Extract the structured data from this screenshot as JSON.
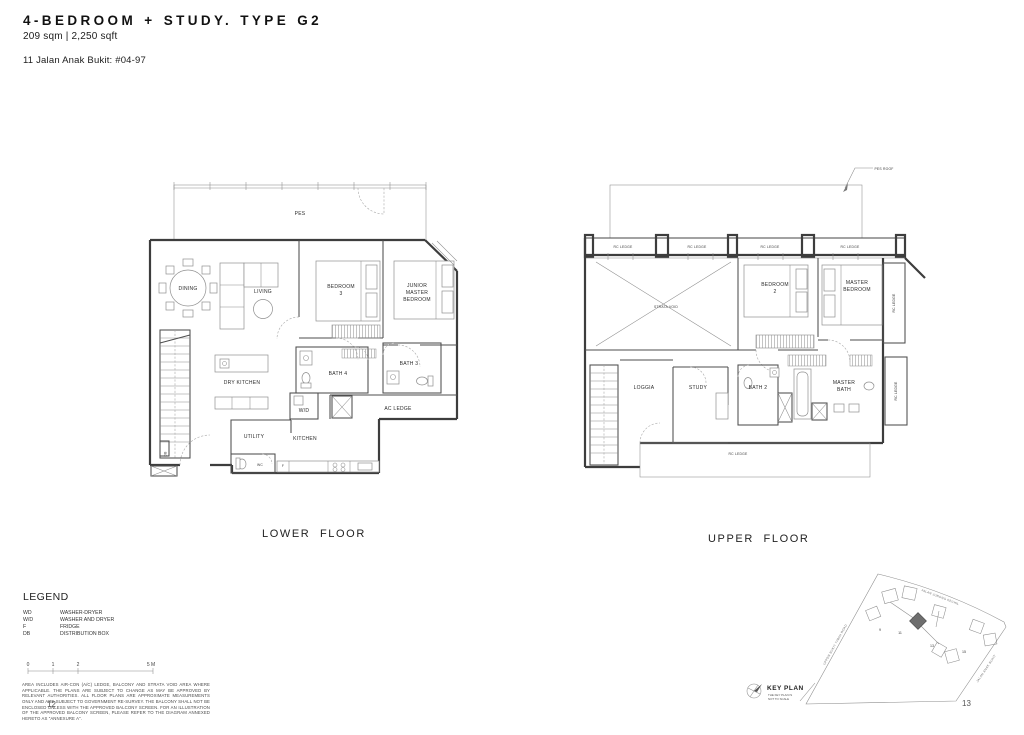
{
  "header": {
    "title": "4-BEDROOM + STUDY. TYPE G2",
    "area": "209 sqm | 2,250 sqft",
    "unit_no": "11 Jalan Anak Bukit: #04-97"
  },
  "floors": {
    "lower_caption": "LOWER FLOOR",
    "upper_caption": "UPPER FLOOR"
  },
  "lower": {
    "pes": "PES",
    "dining": "DINING",
    "living": "LIVING",
    "bedroom3_line1": "BEDROOM",
    "bedroom3_line2": "3",
    "junior_line1": "JUNIOR",
    "junior_line2": "MASTER",
    "junior_line3": "BEDROOM",
    "dry_kitchen": "DRY KITCHEN",
    "utility": "UTILITY",
    "kitchen": "KITCHEN",
    "wc": "WC",
    "bath3": "BATH 3",
    "bath4": "BATH 4",
    "ac_ledge": "AC LEDGE",
    "wd": "W/D",
    "fridge": "F",
    "db": "DB"
  },
  "upper": {
    "pes_roof": "PES ROOF",
    "rc_ledge": "RC LEDGE",
    "strata_void": "STRATA VOID",
    "bedroom2_line1": "BEDROOM",
    "bedroom2_line2": "2",
    "master_line1": "MASTER",
    "master_line2": "BEDROOM",
    "loggia": "LOGGIA",
    "study": "STUDY",
    "bath2": "BATH 2",
    "master_bath_line1": "MASTER",
    "master_bath_line2": "BATH"
  },
  "legend": {
    "title": "LEGEND",
    "items": [
      {
        "abbr": "WD",
        "desc": "WASHER-DRYER"
      },
      {
        "abbr": "W/D",
        "desc": "WASHER AND DRYER"
      },
      {
        "abbr": "F",
        "desc": "FRIDGE"
      },
      {
        "abbr": "DB",
        "desc": "DISTRIBUTION BOX"
      }
    ]
  },
  "scale": {
    "t0": "0",
    "t1": "1",
    "t2": "2",
    "t5": "5 M"
  },
  "disclaimer": "AREA INCLUDES AIR-CON (A/C) LEDGE, BALCONY AND STRATA VOID AREA WHERE APPLICABLE. THE PLANS ARE SUBJECT TO CHANGE AS MAY BE APPROVED BY RELEVANT AUTHORITIES. ALL FLOOR PLANS ARE APPROXIMATE MEASUREMENTS ONLY AND ARE SUBJECT TO GOVERNMENT RE-SURVEY. THE BALCONY SHALL NOT BE ENCLOSED UNLESS WITH THE APPROVED BALCONY SCREEN. FOR AN ILLUSTRATION OF THE APPROVED BALCONY SCREEN, PLEASE REFER TO THE DIAGRAM ANNEXED HERETO AS \"ANNEXURE A\".",
  "pages": {
    "left": "12",
    "right": "13"
  },
  "keyplan": {
    "title": "KEY PLAN",
    "note_line1": "THE KEY PLAN IS",
    "note_line2": "NOT TO SCALE",
    "road_top": "JALAN JURONG KECHIL",
    "road_left": "UPPER BUKIT TIMAH ROAD",
    "road_right": "JALAN ANAK BUKIT",
    "block_9": "9",
    "block_11": "11",
    "block_13": "13",
    "block_15": "15",
    "highlight_color": "#6e6e6e"
  }
}
